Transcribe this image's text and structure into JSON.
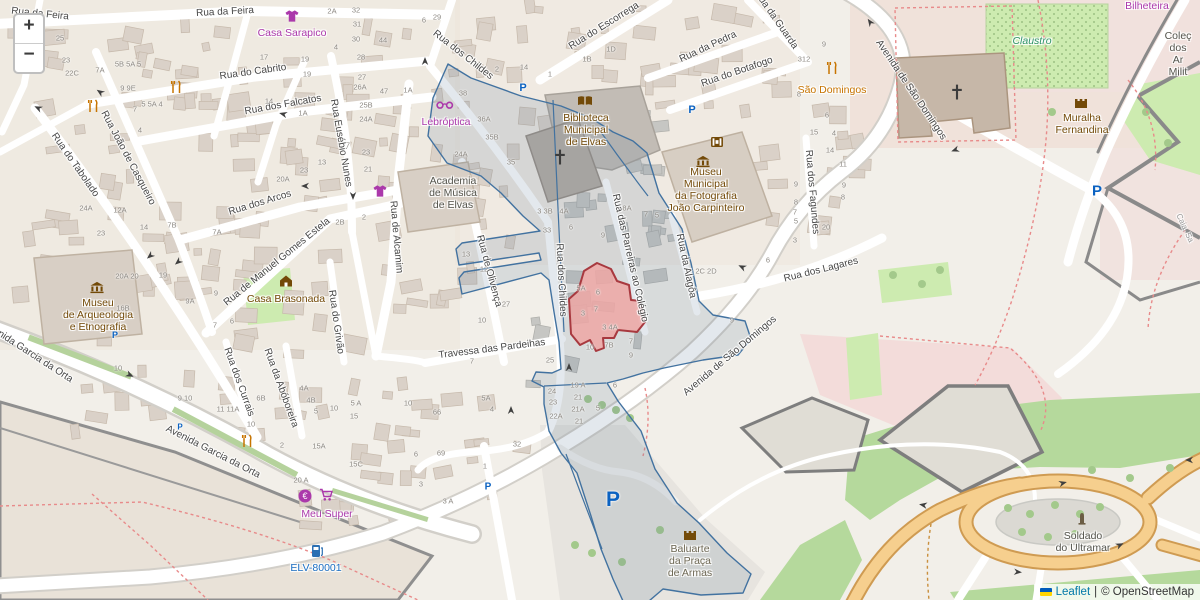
{
  "controls": {
    "zoom_in_label": "+",
    "zoom_out_label": "−"
  },
  "attribution": {
    "flag_icon": "ukraine-flag",
    "leaflet_label": "Leaflet",
    "separator": "|",
    "osm_label": "© OpenStreetMap"
  },
  "colors": {
    "overlay_stroke": "#4272a0",
    "overlay_fill": "rgba(100,125,155,0.18)",
    "selected_fill": "#eea7a4",
    "selected_stroke": "#a8393f",
    "shop_purple": "#ab39ab",
    "poi_brown": "#734a08",
    "amenity_orange": "#c77400",
    "parking_blue": "#0b62c1",
    "link_blue": "#0078A8"
  },
  "street_labels": [
    [
      "Rua da Feira",
      225,
      12,
      -3
    ],
    [
      "Rua da Feira",
      40,
      14,
      6
    ],
    [
      "Rua do Cabrito",
      253,
      72,
      -8
    ],
    [
      "Rua dos Falcatos",
      283,
      105,
      -10
    ],
    [
      "Rua João de Casqueiro",
      128,
      158,
      62
    ],
    [
      "Rua do Tabolado",
      75,
      165,
      55
    ],
    [
      "Rua dos Arcos",
      260,
      203,
      -17
    ],
    [
      "Rua de Manuel Gomes Estela",
      277,
      262,
      -39
    ],
    [
      "Rua Eusébio Nunes",
      341,
      143,
      80
    ],
    [
      "Rua de Alcamim",
      396,
      237,
      85
    ],
    [
      "Rua do Grivão",
      336,
      322,
      82
    ],
    [
      "Rua dos Currais",
      239,
      382,
      70
    ],
    [
      "Rua da Abóboreira",
      281,
      388,
      70
    ],
    [
      "Rua de Olivença",
      489,
      271,
      75
    ],
    [
      "Travessa das Pardeihas",
      492,
      349,
      -7
    ],
    [
      "Rua dos Childes",
      463,
      55,
      38
    ],
    [
      "Rua dos Childes",
      561,
      280,
      87
    ],
    [
      "Rua do Escorrega",
      604,
      26,
      -32
    ],
    [
      "Rua da Pedra",
      708,
      47,
      -25
    ],
    [
      "Rua do Botafogo",
      737,
      72,
      -19
    ],
    [
      "Rua da Guarda",
      776,
      20,
      55
    ],
    [
      "Avenida de São Domingos",
      911,
      90,
      56
    ],
    [
      "Avenida de São Domingos",
      730,
      356,
      -40
    ],
    [
      "Rua dos Lagares",
      821,
      270,
      -14
    ],
    [
      "Rua dos Fagundes",
      812,
      192,
      85
    ],
    [
      "Rua da Alagôa",
      686,
      266,
      78
    ],
    [
      "Rua das Parreiras ao Colégio",
      630,
      258,
      77
    ],
    [
      "Avenida Garcia da Orta",
      28,
      352,
      33
    ],
    [
      "Avenida Garcia da Orta",
      213,
      452,
      27
    ],
    [
      "Caia, Sa",
      1185,
      228,
      65
    ]
  ],
  "poi_labels": [
    {
      "id": "casa-sarapico",
      "lines": [
        "Casa Sarapico"
      ],
      "x": 292,
      "y": 27,
      "color": "purple"
    },
    {
      "id": "lebroptica",
      "lines": [
        "Lebróptica"
      ],
      "x": 446,
      "y": 116,
      "color": "purple"
    },
    {
      "id": "biblioteca",
      "lines": [
        "Biblioteca",
        "Municipal",
        "de Elvas"
      ],
      "x": 586,
      "y": 112,
      "color": "brown"
    },
    {
      "id": "museu-fotografia",
      "lines": [
        "Museu",
        "Municipal",
        "da Fotografia",
        "João Carpinteiro"
      ],
      "x": 706,
      "y": 166,
      "color": "brown"
    },
    {
      "id": "academia-musica",
      "lines": [
        "Academia",
        "de Música",
        "de Elvas"
      ],
      "x": 453,
      "y": 175,
      "color": "dark"
    },
    {
      "id": "museu-arqueologia",
      "lines": [
        "Museu",
        "de Arqueologia",
        "e Etnografia"
      ],
      "x": 98,
      "y": 297,
      "color": "brown"
    },
    {
      "id": "casa-brasonada",
      "lines": [
        "Casa Brasonada"
      ],
      "x": 286,
      "y": 293,
      "color": "brown"
    },
    {
      "id": "sao-domingos",
      "lines": [
        "São Domingos"
      ],
      "x": 832,
      "y": 84,
      "color": "orange"
    },
    {
      "id": "muralha-fernandina",
      "lines": [
        "Muralha",
        "Fernandina"
      ],
      "x": 1082,
      "y": 112,
      "color": "brown"
    },
    {
      "id": "claustro",
      "lines": [
        "Claustro"
      ],
      "x": 1032,
      "y": 35,
      "color": "green"
    },
    {
      "id": "bilheteira",
      "lines": [
        "Bilheteira"
      ],
      "x": 1147,
      "y": 0,
      "color": "purple"
    },
    {
      "id": "colecao-militar",
      "lines": [
        "Coleç",
        "dos Ar",
        "Milit"
      ],
      "x": 1178,
      "y": 30,
      "color": "dark"
    },
    {
      "id": "meu-super",
      "lines": [
        "Meu Super"
      ],
      "x": 327,
      "y": 508,
      "color": "purple"
    },
    {
      "id": "soldado-ultramar",
      "lines": [
        "Soldado",
        "do Ultramar"
      ],
      "x": 1083,
      "y": 530,
      "color": "dark"
    },
    {
      "id": "baluarte",
      "lines": [
        "Baluarte",
        "da Praça",
        "de Armas"
      ],
      "x": 690,
      "y": 543,
      "color": "olive"
    },
    {
      "id": "elv-station",
      "lines": [
        "ELV-80001"
      ],
      "x": 316,
      "y": 562,
      "color": "blue"
    }
  ],
  "markers": [
    {
      "t": "tshirt",
      "x": 292,
      "y": 16
    },
    {
      "t": "tshirt",
      "x": 380,
      "y": 191
    },
    {
      "t": "glasses",
      "x": 445,
      "y": 105
    },
    {
      "t": "book",
      "x": 585,
      "y": 101
    },
    {
      "t": "museum",
      "x": 97,
      "y": 287
    },
    {
      "t": "museum",
      "x": 703,
      "y": 161
    },
    {
      "t": "film",
      "x": 717,
      "y": 142
    },
    {
      "t": "house",
      "x": 286,
      "y": 281
    },
    {
      "t": "cutlery",
      "x": 832,
      "y": 68
    },
    {
      "t": "cutlery",
      "x": 176,
      "y": 87
    },
    {
      "t": "cutlery",
      "x": 93,
      "y": 106
    },
    {
      "t": "cutlery",
      "x": 247,
      "y": 441
    },
    {
      "t": "castle",
      "x": 1081,
      "y": 102
    },
    {
      "t": "fort",
      "x": 690,
      "y": 534
    },
    {
      "t": "monument",
      "x": 1082,
      "y": 518
    },
    {
      "t": "euro",
      "x": 305,
      "y": 496
    },
    {
      "t": "cart",
      "x": 326,
      "y": 495
    },
    {
      "t": "charge",
      "x": 317,
      "y": 551
    },
    {
      "t": "cross",
      "x": 560,
      "y": 157
    },
    {
      "t": "cross",
      "x": 957,
      "y": 92
    }
  ],
  "parking": [
    [
      523,
      88,
      11
    ],
    [
      692,
      110,
      11
    ],
    [
      1097,
      191,
      15
    ],
    [
      115,
      335,
      9
    ],
    [
      180,
      427,
      8
    ],
    [
      488,
      487,
      10
    ],
    [
      613,
      500,
      21
    ]
  ],
  "arrows": [
    [
      38,
      108,
      205
    ],
    [
      100,
      92,
      215
    ],
    [
      283,
      114,
      195
    ],
    [
      425,
      61,
      -90
    ],
    [
      353,
      196,
      90
    ],
    [
      305,
      186,
      180
    ],
    [
      150,
      256,
      140
    ],
    [
      178,
      262,
      140
    ],
    [
      569,
      367,
      -90
    ],
    [
      511,
      410,
      -90
    ],
    [
      955,
      150,
      160
    ],
    [
      742,
      267,
      205
    ],
    [
      130,
      375,
      25
    ],
    [
      870,
      22,
      235
    ],
    [
      923,
      505,
      190
    ],
    [
      1063,
      483,
      -15
    ],
    [
      1018,
      572,
      5
    ],
    [
      1120,
      545,
      -25
    ],
    [
      1189,
      460,
      180
    ]
  ],
  "house_numbers": [
    [
      "25",
      60,
      38
    ],
    [
      "23",
      66,
      60
    ],
    [
      "22C",
      72,
      73
    ],
    [
      "7A",
      100,
      70
    ],
    [
      "5B 5A 5",
      128,
      64
    ],
    [
      "9 9E",
      128,
      88
    ],
    [
      "7",
      135,
      109
    ],
    [
      "5 5A 4",
      152,
      104
    ],
    [
      "4",
      140,
      130
    ],
    [
      "17",
      264,
      57
    ],
    [
      "19",
      305,
      59
    ],
    [
      "19",
      307,
      74
    ],
    [
      "14",
      269,
      101
    ],
    [
      "1A",
      303,
      113
    ],
    [
      "2A",
      332,
      11
    ],
    [
      "32",
      356,
      10
    ],
    [
      "31",
      357,
      24
    ],
    [
      "30",
      356,
      39
    ],
    [
      "44",
      383,
      40
    ],
    [
      "4",
      336,
      47
    ],
    [
      "28",
      361,
      57
    ],
    [
      "27",
      362,
      77
    ],
    [
      "26A",
      360,
      87
    ],
    [
      "47",
      384,
      91
    ],
    [
      "1A",
      408,
      90
    ],
    [
      "25B",
      366,
      105
    ],
    [
      "24A",
      366,
      119
    ],
    [
      "6",
      424,
      20
    ],
    [
      "29",
      437,
      17
    ],
    [
      "23",
      366,
      152
    ],
    [
      "21",
      368,
      169
    ],
    [
      "13",
      322,
      162
    ],
    [
      "23",
      304,
      170
    ],
    [
      "7",
      348,
      145
    ],
    [
      "20A",
      283,
      179
    ],
    [
      "2B",
      340,
      222
    ],
    [
      "2",
      364,
      217
    ],
    [
      "12A",
      120,
      210
    ],
    [
      "24A",
      86,
      208
    ],
    [
      "23",
      101,
      233
    ],
    [
      "14",
      144,
      227
    ],
    [
      "20A 20",
      127,
      276
    ],
    [
      "19",
      163,
      275
    ],
    [
      "7B",
      172,
      225
    ],
    [
      "7A",
      217,
      232
    ],
    [
      "9A",
      190,
      301
    ],
    [
      "9",
      216,
      293
    ],
    [
      "7",
      215,
      325
    ],
    [
      "6",
      232,
      321
    ],
    [
      "16B",
      123,
      308
    ],
    [
      "10",
      118,
      368
    ],
    [
      "2",
      497,
      69
    ],
    [
      "14",
      524,
      67
    ],
    [
      "1",
      550,
      74
    ],
    [
      "1B",
      587,
      59
    ],
    [
      "1D",
      611,
      49
    ],
    [
      "38",
      463,
      93
    ],
    [
      "36A",
      484,
      119
    ],
    [
      "35B",
      492,
      137
    ],
    [
      "24A",
      461,
      154
    ],
    [
      "35",
      511,
      162
    ],
    [
      "13",
      466,
      254
    ],
    [
      "12",
      484,
      269
    ],
    [
      "27",
      506,
      304
    ],
    [
      "10",
      482,
      320
    ],
    [
      "3 3B",
      545,
      211
    ],
    [
      "4A",
      564,
      211
    ],
    [
      "6",
      571,
      227
    ],
    [
      "33",
      547,
      230
    ],
    [
      "9",
      603,
      235
    ],
    [
      "8A",
      627,
      208
    ],
    [
      "7",
      646,
      214
    ],
    [
      "5",
      657,
      215
    ],
    [
      "5A",
      581,
      288
    ],
    [
      "6",
      598,
      292
    ],
    [
      "7",
      596,
      309
    ],
    [
      "3",
      583,
      313
    ],
    [
      "3 4A",
      610,
      327
    ],
    [
      "10",
      590,
      347
    ],
    [
      "7B",
      609,
      345
    ],
    [
      "7",
      631,
      341
    ],
    [
      "9",
      631,
      355
    ],
    [
      "25",
      550,
      360
    ],
    [
      "19 A",
      578,
      385
    ],
    [
      "24",
      552,
      391
    ],
    [
      "23",
      553,
      402
    ],
    [
      "22A",
      556,
      416
    ],
    [
      "21",
      578,
      397
    ],
    [
      "21A",
      578,
      409
    ],
    [
      "21",
      579,
      421
    ],
    [
      "5",
      598,
      408
    ],
    [
      "6",
      615,
      385
    ],
    [
      "32",
      517,
      444
    ],
    [
      "7",
      472,
      361
    ],
    [
      "66",
      437,
      412
    ],
    [
      "5A",
      486,
      398
    ],
    [
      "4",
      492,
      409
    ],
    [
      "6",
      416,
      454
    ],
    [
      "69",
      441,
      453
    ],
    [
      "3",
      421,
      484
    ],
    [
      "1",
      485,
      466
    ],
    [
      "3 A",
      448,
      501
    ],
    [
      "10",
      408,
      403
    ],
    [
      "9 10",
      185,
      398
    ],
    [
      "11 11A",
      228,
      409
    ],
    [
      "10",
      251,
      424
    ],
    [
      "6B",
      261,
      398
    ],
    [
      "4A",
      304,
      388
    ],
    [
      "4B",
      311,
      400
    ],
    [
      "5",
      316,
      411
    ],
    [
      "5 A",
      356,
      403
    ],
    [
      "10",
      334,
      408
    ],
    [
      "15",
      354,
      416
    ],
    [
      "2",
      282,
      445
    ],
    [
      "15A",
      319,
      446
    ],
    [
      "15C",
      356,
      464
    ],
    [
      "20 A",
      301,
      480
    ],
    [
      "15",
      814,
      132
    ],
    [
      "4",
      834,
      133
    ],
    [
      "14",
      830,
      150
    ],
    [
      "11",
      843,
      164
    ],
    [
      "9",
      796,
      184
    ],
    [
      "9",
      844,
      185
    ],
    [
      "8",
      843,
      197
    ],
    [
      "8",
      796,
      202
    ],
    [
      "7",
      795,
      212
    ],
    [
      "5",
      796,
      221
    ],
    [
      "20",
      826,
      227
    ],
    [
      "3",
      795,
      240
    ],
    [
      "6",
      768,
      260
    ],
    [
      "2C 2D",
      706,
      271
    ],
    [
      "9",
      732,
      320
    ],
    [
      "9",
      824,
      44
    ],
    [
      "312",
      804,
      59
    ],
    [
      "8",
      799,
      94
    ],
    [
      "6",
      827,
      115
    ]
  ]
}
